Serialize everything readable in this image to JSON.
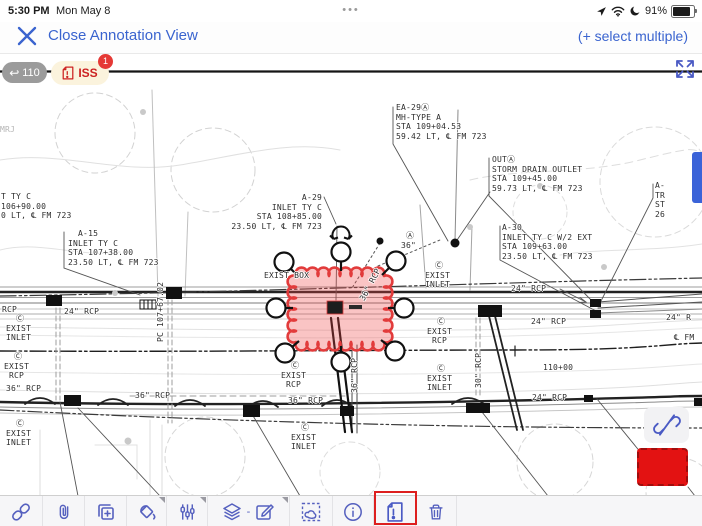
{
  "status_bar": {
    "time": "5:30 PM",
    "date": "Mon May 8",
    "menu_dots": "•••",
    "battery_percent": "91%",
    "icons": [
      "location-icon",
      "wifi-icon",
      "moon-icon",
      "battery-icon"
    ]
  },
  "nav_bar": {
    "close_label": "Close Annotation View",
    "select_multiple_label": "(+ select multiple)"
  },
  "markup_bar": {
    "undo_arrow": "↩",
    "revision_count": "110",
    "issue_label": "ISS",
    "issue_badge_count": "1"
  },
  "drawing": {
    "blocks": [
      {
        "t": "EA-29Ⓐ\nMH-TYPE A\nSTA 109+04.53\n59.42 LT, ℄ FM 723"
      },
      {
        "t": "OUTⒶ\nSTORM DRAIN OUTLET\nSTA 109+45.00\n59.73 LT, ℄ FM 723"
      },
      {
        "t": "A-\nTR\nST\n26"
      },
      {
        "t": "T TY C\n106+90.00\n0 LT, ℄ FM 723"
      },
      {
        "t": "  A-15\nINLET TY C\nSTA 107+38.00\n23.50 LT, ℄ FM 723"
      },
      {
        "t": "A-29\nINLET TY C\nSTA 108+85.00\n23.50 LT, ℄ FM 723"
      },
      {
        "t": "A-30\nINLET TY C W/2 EXT\nSTA 109+63.00\n23.50 LT, ℄ FM 723"
      },
      {
        "t": " Ⓐ\n36\""
      },
      {
        "t": "  Ⓒ\nEXIST\nINLET"
      },
      {
        "t": "  Ⓒ\nEXIST\n RCP"
      },
      {
        "t": "  Ⓒ\nEXIST\n RCP"
      },
      {
        "t": "  Ⓒ\nEXIST\nINLET"
      },
      {
        "t": "  Ⓒ\nEXIST\n RCP"
      },
      {
        "t": "  Ⓒ\nEXIST\nINLET"
      },
      {
        "t": "  Ⓒ\nEXIST\nINLET"
      },
      {
        "t": "  Ⓒ\nEXIST\nINLET"
      }
    ],
    "labels": [
      {
        "t": "RCP"
      },
      {
        "t": "24\" RCP"
      },
      {
        "t": "36\" RCP"
      },
      {
        "t": "36\" RCP"
      },
      {
        "t": "36\" RCP"
      },
      {
        "t": "24\" RCP"
      },
      {
        "t": "24\" RCP"
      },
      {
        "t": "24\" RCP"
      },
      {
        "t": "℄ FM"
      },
      {
        "t": "110+00"
      },
      {
        "t": "24\" R"
      },
      {
        "t": "EXIST BOX"
      },
      {
        "t": "MRJ"
      }
    ],
    "vlabels": [
      {
        "t": "PC 107+67.02"
      },
      {
        "t": "30\" RCP"
      },
      {
        "t": "36\" RCP"
      },
      {
        "t": "36\" RCP"
      }
    ]
  },
  "annotation": {
    "cloud": {
      "type": "revision-cloud",
      "fill": "#f04848",
      "fill_opacity": "0.32",
      "stroke": "#e23b3b"
    },
    "rectangle": {
      "fill": "#e31212",
      "border": "#9e0d0d"
    }
  },
  "toolbar": {
    "items": [
      {
        "name": "link"
      },
      {
        "name": "attachment"
      },
      {
        "name": "duplicate"
      },
      {
        "name": "fill-color"
      },
      {
        "name": "properties"
      },
      {
        "name": "layers-spaces"
      },
      {
        "name": "lasso-select"
      },
      {
        "name": "info"
      },
      {
        "name": "flag-document"
      },
      {
        "name": "trash"
      }
    ],
    "layers_separator": "-",
    "selected_tool": "flag-document",
    "selection_color": "#dd1f1f"
  },
  "colors": {
    "accent_blue": "#3a64cf",
    "toolbar_icon_blue": "#5560bf",
    "issue_red": "#cc2222",
    "badge_red": "#e53935",
    "scroll_indicator": "#3b63d8"
  }
}
